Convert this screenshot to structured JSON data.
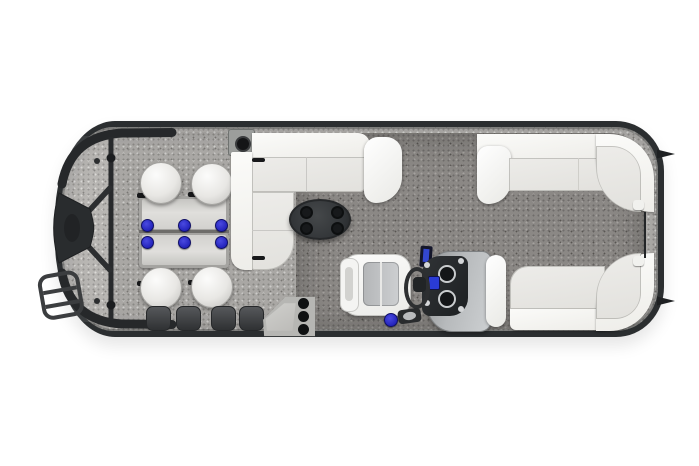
{
  "scene": {
    "label": "Pontoon boat floor plan, overhead top view on white background",
    "background_color": "#ffffff"
  },
  "hull": {
    "label": "Pontoon hull with charcoal rail and speckled gray deck trim",
    "hull_color": "#2b2e30",
    "trim_carpet_color": "#b2b0ad",
    "aft_carpet_color": "#8b8885",
    "cleat_count": 2
  },
  "bow": {
    "label": "Bow deck with front gate, fence rail and boarding ladder",
    "gate_label": "bow nose gate",
    "fence_label": "bow fence rail",
    "ladder_label": "boarding ladder",
    "rail_color": "#2a2c2e"
  },
  "dinette": {
    "label": "Forward dinette: two rectangular tables with four round stools",
    "table_count": 2,
    "stool_count": 4,
    "table_color": "#d6d5d2",
    "cupholder_count": 6,
    "cupholder_color": "#2424bc"
  },
  "lounge": {
    "label": "Midship L-shaped lounge sofa",
    "back_color": "#f3f3f1",
    "seat_color": "#e7e6e3",
    "speaker_label": "corner speaker box",
    "cocktail_table": {
      "label": "oval cocktail table",
      "color": "#393c3e",
      "cupholder_count": 4
    }
  },
  "helm": {
    "label": "Helm station with console, wheel and captain chair",
    "console_color": "#b7babc",
    "dash_color": "#212427",
    "gauge_count": 2,
    "screen_color": "#2a3bd6",
    "wheel_label": "steering wheel",
    "throttle_label": "throttle lever",
    "fishfinder_label": "fish finder display",
    "cupholder_color": "#2727c2",
    "captain_chair": {
      "label": "captain chair",
      "shell_color": "#f0f0ee",
      "insert_color": "#c3c5c6"
    }
  },
  "stern": {
    "label": "Stern wraparound lounge benches with rear entry gate",
    "top_bench_label": "starboard aft L-bench",
    "bottom_bench_label": "port aft L-bench",
    "bench_back_color": "#f3f3f1",
    "bench_seat_color": "#e8e7e4",
    "rear_gate_label": "rear entry gate"
  },
  "port_side": {
    "entry_step": {
      "label": "side entry step pad",
      "dot_count": 3,
      "color": "#b6b6b3"
    },
    "floor_recess_count": 4
  }
}
